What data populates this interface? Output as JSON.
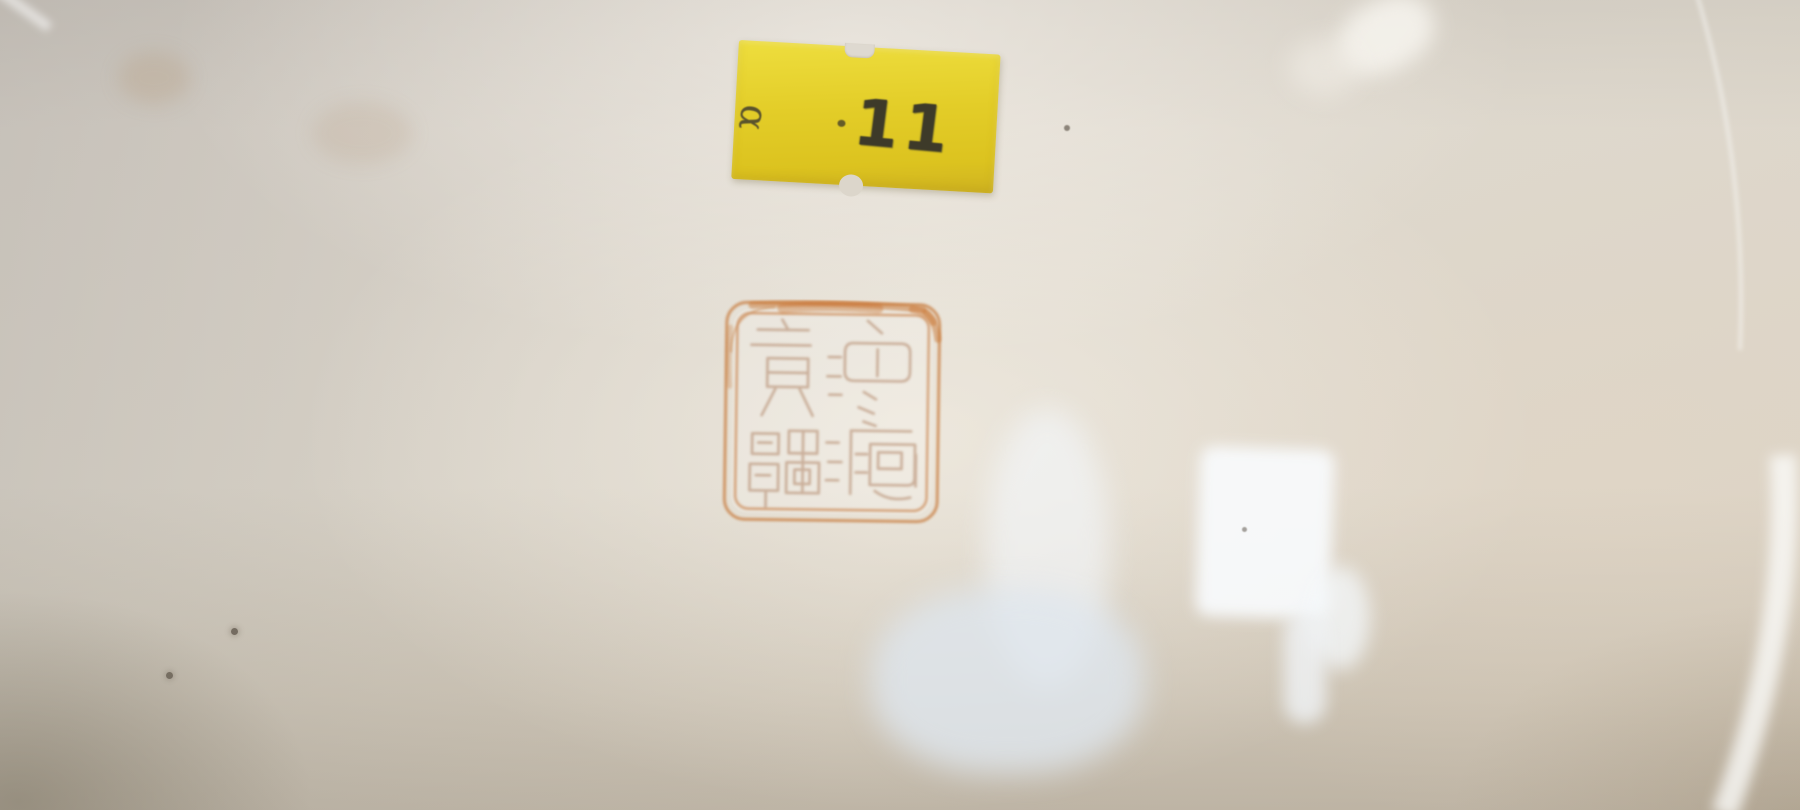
{
  "scene": {
    "subject": "Close-up photograph of the glazed base of a porcelain dish",
    "elements": "yellow lot sticker, iron-red square seal mark, glaze reflections, small stains and specks"
  },
  "sticker": {
    "code_letter": "α",
    "lot_number": "11",
    "paper_color": "#e3cd28",
    "ink_color": "#3d3a29"
  },
  "seal": {
    "kind": "square seal mark with rounded double border and seal-script characters",
    "pigment_color": "#c97f46",
    "smear_color": "#c76f28",
    "character_color": "#ab7c5c"
  },
  "glaze": {
    "base_color": "#dcd5ca",
    "shadow_color": "#7a6f5c",
    "highlight_color": "#f2f5f8",
    "cool_highlight_color": "#dfe5ec",
    "stain_color": "#b08e64"
  }
}
